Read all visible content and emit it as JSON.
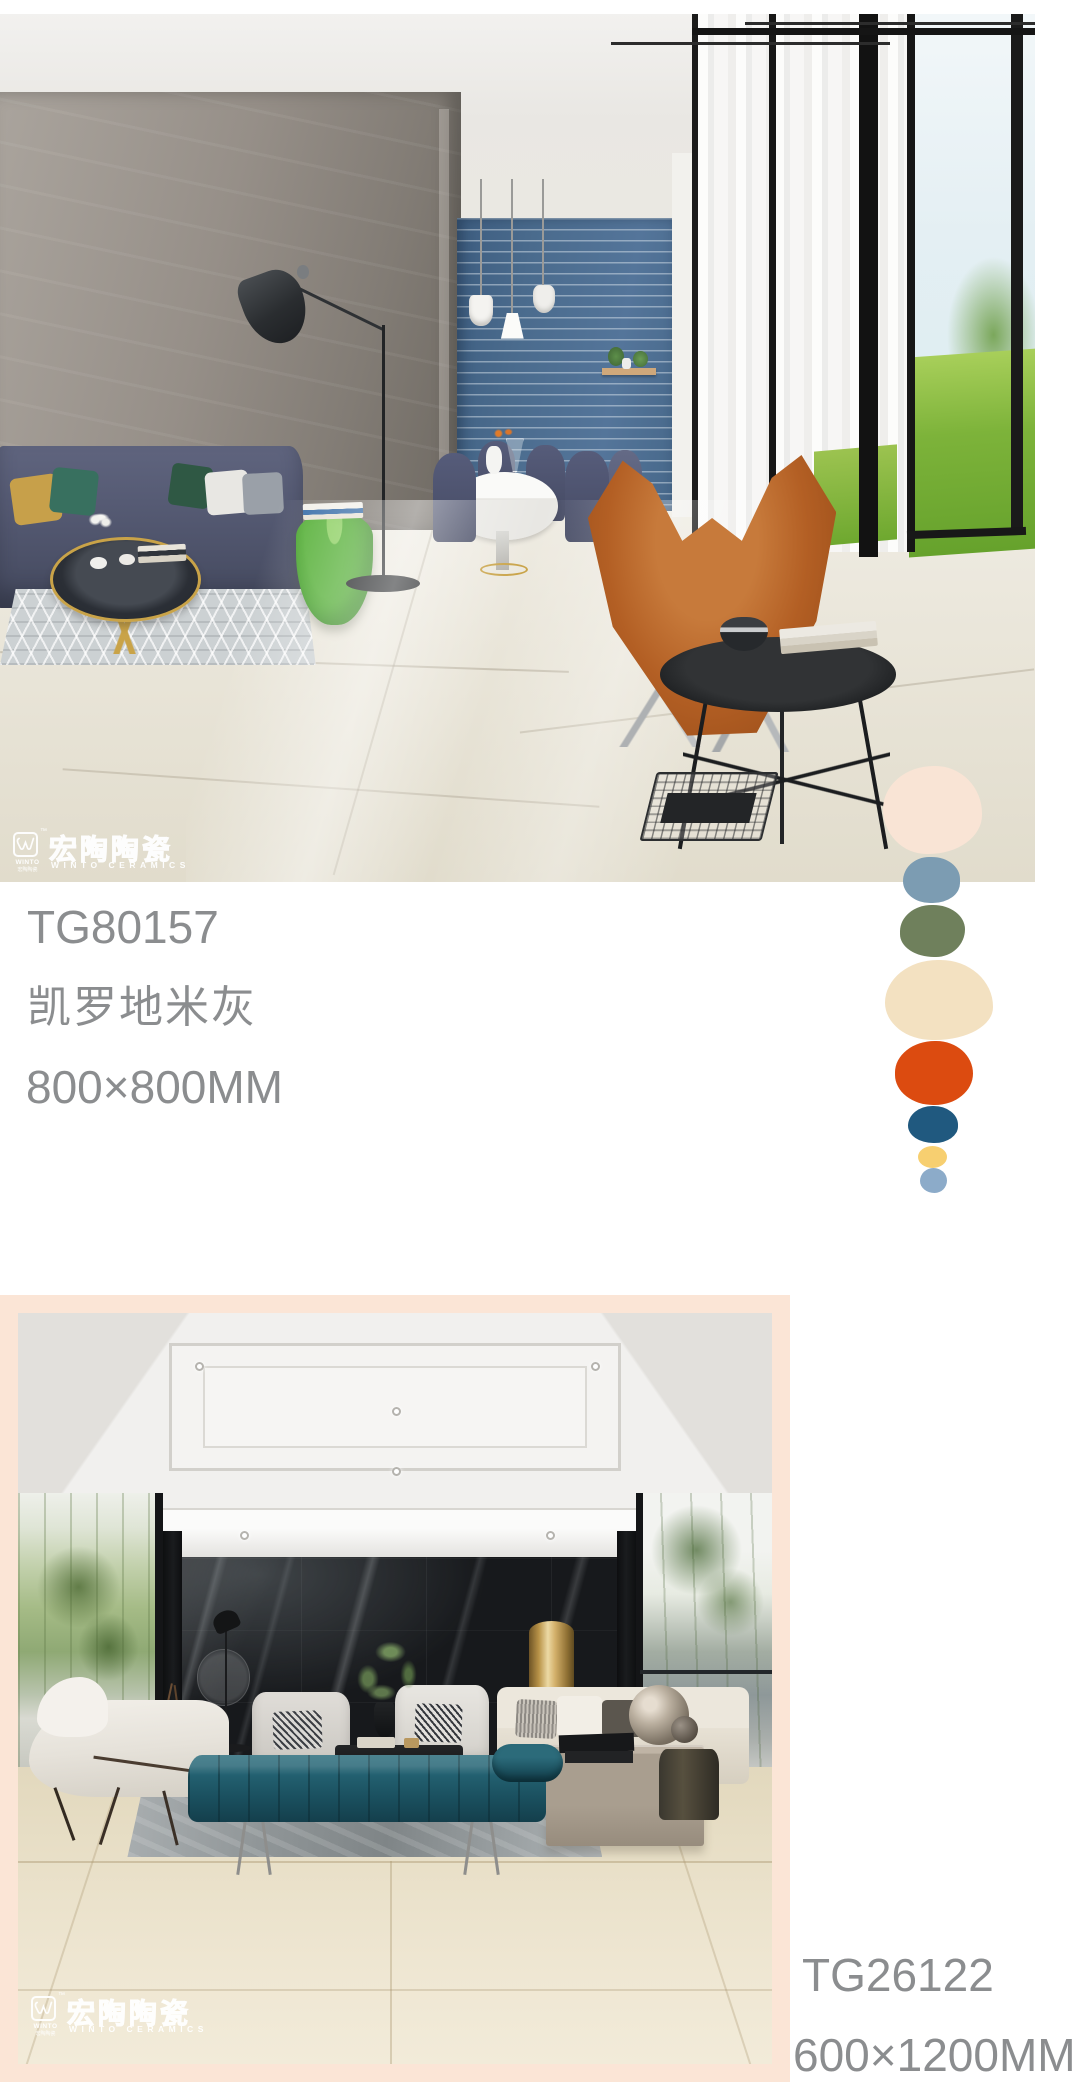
{
  "brand": {
    "name_cn": "宏陶陶瓷",
    "name_en": "WINTO CERAMICS",
    "mark_word": "WINTO",
    "mark_sub_cn": "宏陶陶瓷",
    "trademark": "™"
  },
  "products": [
    {
      "code": "TG80157",
      "name": "凯罗地米灰",
      "size": "800×800MM"
    },
    {
      "code": "TG26122",
      "size": "600×1200MM"
    }
  ],
  "palette": {
    "swatches": [
      {
        "name": "blush",
        "color": "#f9e4d5"
      },
      {
        "name": "steel-blue",
        "color": "#7c9cb2"
      },
      {
        "name": "olive",
        "color": "#6f805c"
      },
      {
        "name": "cream",
        "color": "#f3e1c1"
      },
      {
        "name": "orange",
        "color": "#dc4b10"
      },
      {
        "name": "navy",
        "color": "#20597f"
      },
      {
        "name": "yellow",
        "color": "#f7cf70"
      },
      {
        "name": "sky-blue",
        "color": "#8cabc9"
      }
    ]
  },
  "colors": {
    "text": "#8b8d8f",
    "frame": "#fbe5d6"
  }
}
